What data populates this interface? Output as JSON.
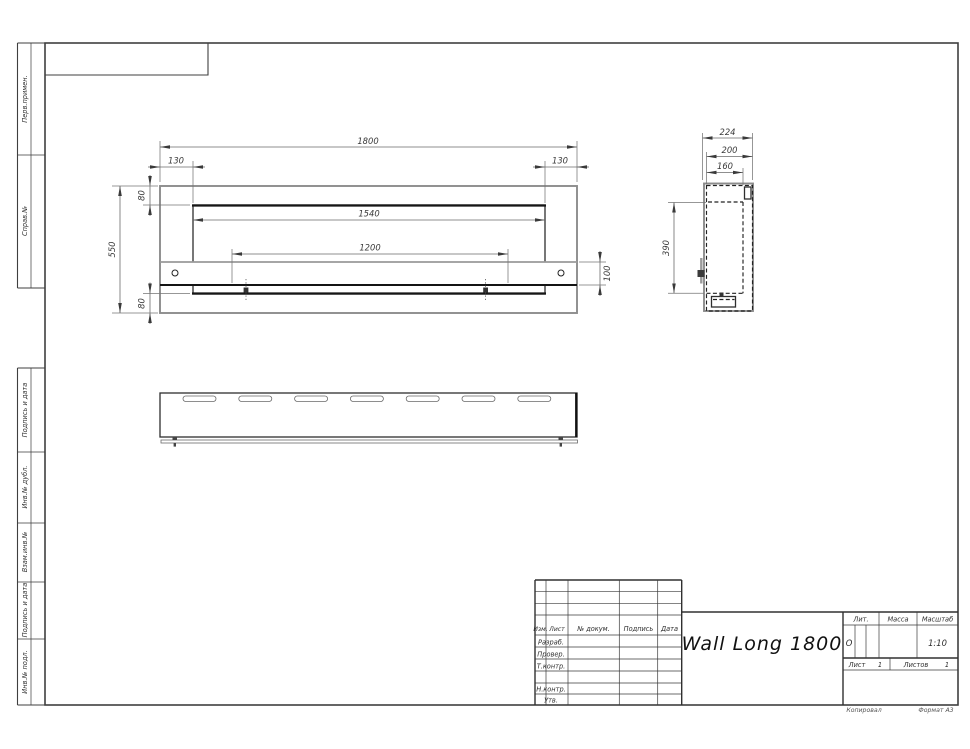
{
  "sheet": {
    "copied_label": "Копировал",
    "format_label": "Формат А3"
  },
  "margin": {
    "labels": [
      {
        "text": "Перв.примен."
      },
      {
        "text": "Справ.№"
      },
      {
        "text": "Подпись и дата"
      },
      {
        "text": "Инв.№ дубл."
      },
      {
        "text": "Взам.инв.№"
      },
      {
        "text": "Подпись и дата"
      },
      {
        "text": "Инв.№ подл."
      }
    ]
  },
  "title_block": {
    "product_name": "Wall Long 1800",
    "col_izm": "Изм.",
    "col_list": "Лист",
    "col_doc": "№ докум.",
    "col_sign": "Подпись",
    "col_date": "Дата",
    "row_developed": "Разраб.",
    "row_checked": "Провер.",
    "row_tcontrol": "Т.контр.",
    "row_ncontrol": "Н.контр.",
    "row_approved": "Утв.",
    "lit_label": "Лит.",
    "mass_label": "Масса",
    "scale_label": "Масштаб",
    "lit_value": "О",
    "scale_value": "1:10",
    "sheet_label": "Лист",
    "sheet_number": "1",
    "sheets_label": "Листов",
    "sheets_total": "1"
  },
  "dimensions": {
    "overall_width": "1800",
    "left_inset": "130",
    "right_inset": "130",
    "top_flange": "80",
    "bottom_flange": "80",
    "opening_width": "1540",
    "burner_width": "1200",
    "overall_height": "550",
    "shelf_height": "100",
    "depth_overall": "224",
    "depth_body": "200",
    "depth_inner": "160",
    "side_height": "390"
  },
  "colors": {
    "line_dark": "#161616",
    "line_gray": "#8c8c8c",
    "paper": "#ffffff"
  }
}
